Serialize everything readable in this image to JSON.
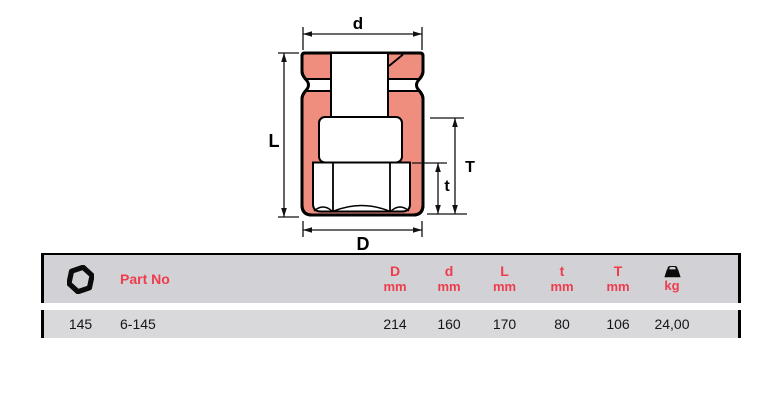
{
  "diagram": {
    "labels": {
      "top": "d",
      "left": "L",
      "right_outer": "T",
      "right_inner": "t",
      "bottom": "D"
    },
    "colors": {
      "section_fill": "#ef8e7e",
      "outline": "#000000"
    }
  },
  "table": {
    "header": {
      "hex_icon": "hex-nut-icon",
      "part_no_label": "Part No",
      "columns": [
        {
          "letter": "D",
          "unit": "mm"
        },
        {
          "letter": "d",
          "unit": "mm"
        },
        {
          "letter": "L",
          "unit": "mm"
        },
        {
          "letter": "t",
          "unit": "mm"
        },
        {
          "letter": "T",
          "unit": "mm"
        }
      ],
      "weight_icon": "weight-icon",
      "weight_unit": "kg"
    },
    "rows": [
      {
        "size": "145",
        "part_no": "6-145",
        "D": "214",
        "d": "160",
        "L": "170",
        "t": "80",
        "T": "106",
        "kg": "24,00"
      }
    ],
    "colors": {
      "header_bg": "#d2d2d6",
      "row_bg": "#d9d9dc",
      "accent": "#ee3c4c"
    }
  }
}
